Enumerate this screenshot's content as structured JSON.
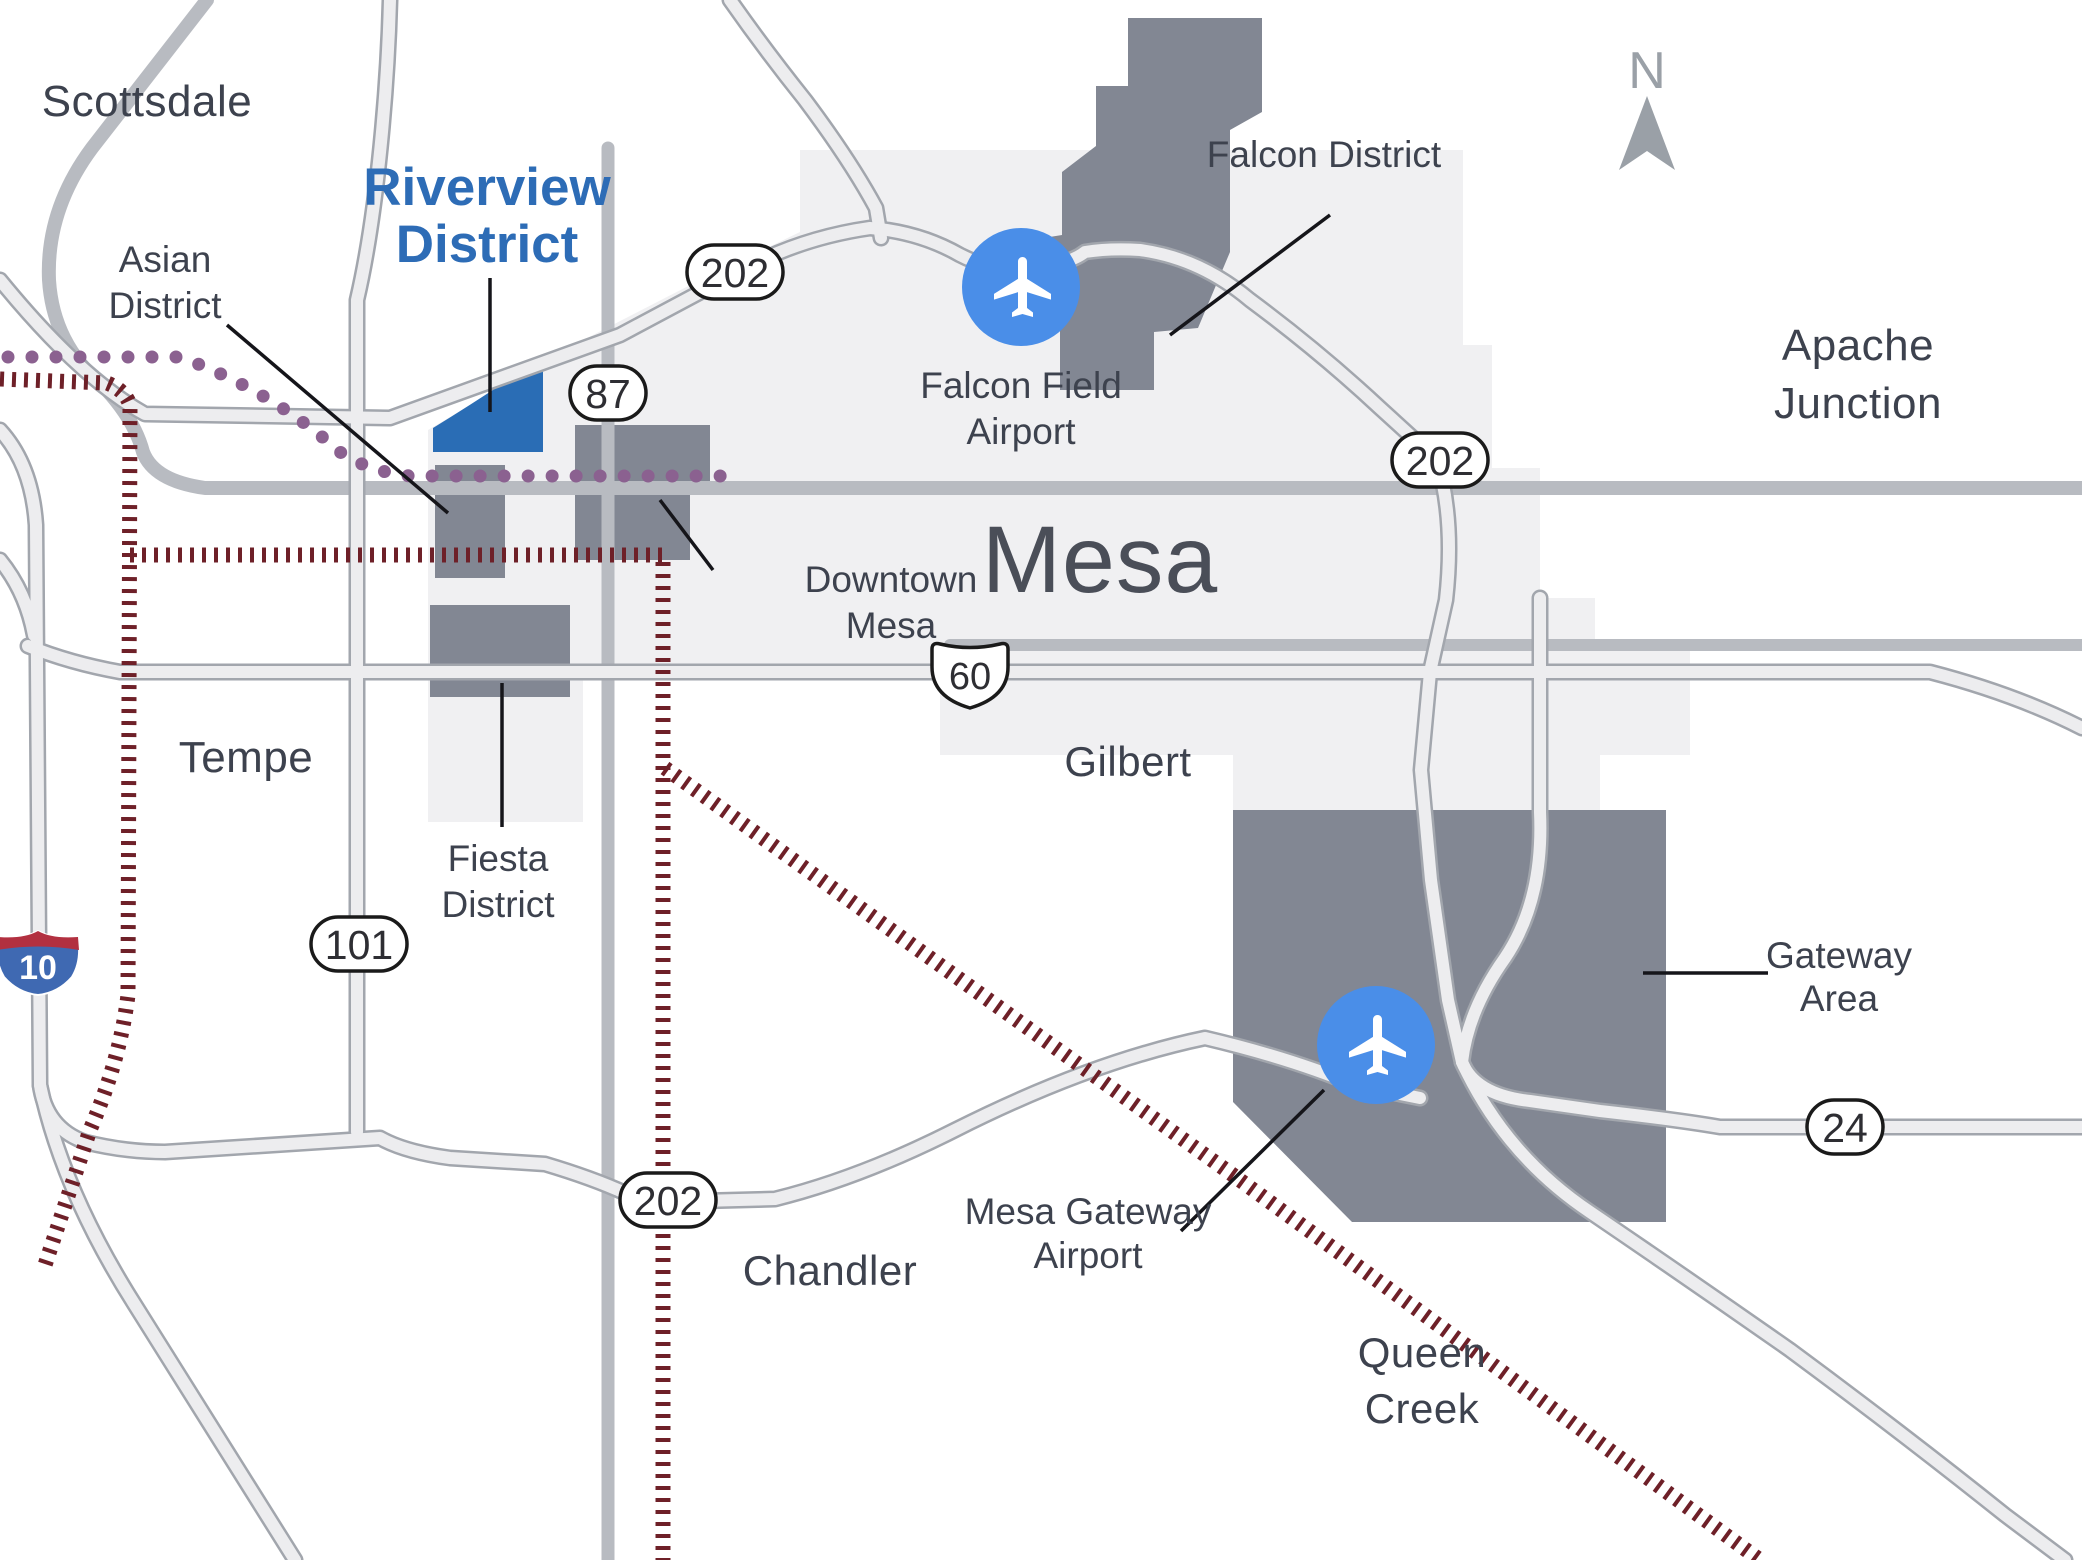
{
  "compass": {
    "label": "N"
  },
  "cities": {
    "scottsdale": "Scottsdale",
    "apache_junction": [
      "Apache",
      "Junction"
    ],
    "mesa": "Mesa",
    "tempe": "Tempe",
    "gilbert": "Gilbert",
    "chandler": "Chandler",
    "queen_creek": [
      "Queen",
      "Creek"
    ]
  },
  "districts": {
    "riverview": [
      "Riverview",
      "District"
    ],
    "asian": [
      "Asian",
      "District"
    ],
    "falcon": "Falcon District",
    "downtown": [
      "Downtown",
      "Mesa"
    ],
    "fiesta": [
      "Fiesta",
      "District"
    ],
    "gateway": [
      "Gateway",
      "Area"
    ]
  },
  "airports": {
    "falcon_field": [
      "Falcon Field",
      "Airport"
    ],
    "mesa_gateway": [
      "Mesa Gateway",
      "Airport"
    ]
  },
  "route_shields": {
    "loop_202": "202",
    "sr_87": "87",
    "us_60": "60",
    "loop_101": "101",
    "sr_24": "24",
    "i_10": "10"
  },
  "legend_colors": {
    "highlight_district_blue": "#2a6db5",
    "district_gray": "#828793",
    "city_area_gray": "#f0f0f2",
    "boundary_maroon": "#6e2028",
    "light_rail_purple": "#8b6190",
    "airport_icon_blue": "#4a8ee8"
  }
}
